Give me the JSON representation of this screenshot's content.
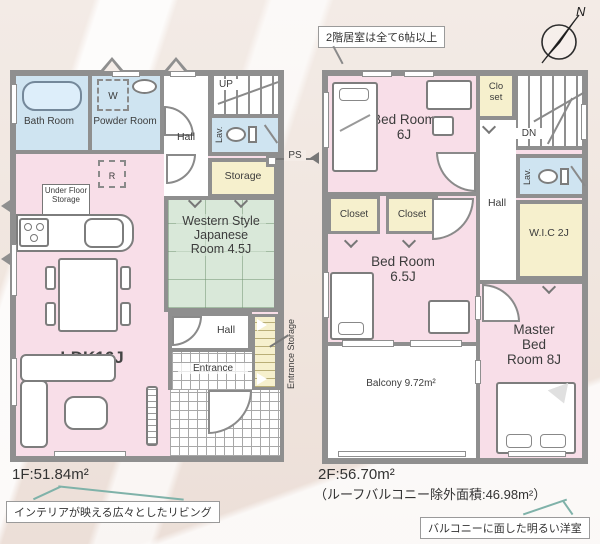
{
  "compass": {
    "north": "N"
  },
  "callouts": {
    "top": "2階居室は全て6帖以上",
    "bottom_left": "インテリアが映える広々としたリビング",
    "bottom_right": "バルコニーに面した明るい洋室"
  },
  "floor1": {
    "area": "1F:51.84m²",
    "bath": "Bath Room",
    "powder": "Powder Room",
    "washer": "W",
    "up": "UP",
    "hall_top": "Hall",
    "lav": "Lav.",
    "storage": "Storage",
    "ps": "PS",
    "fridge": "R",
    "under_floor_storage": "Under Floor Storage",
    "ldk": "LDK16J",
    "japanese_room": "Western Style Japanese Room 4.5J",
    "hall_bottom": "Hall",
    "entrance": "Entrance",
    "entrance_storage": "Entrance Storage"
  },
  "floor2": {
    "area": "2F:56.70m²",
    "area_note": "（ルーフバルコニー除外面積:46.98m²）",
    "closet_small": "Clo set",
    "dn": "DN",
    "hall": "Hall",
    "lav": "Lav.",
    "wic": "W.I.C 2J",
    "bedroom1": "Bed Room 6J",
    "closet1": "Closet",
    "closet2": "Closet",
    "bedroom2": "Bed Room 6.5J",
    "balcony": "Balcony 9.72m²",
    "master": "Master Bed Room 8J"
  }
}
